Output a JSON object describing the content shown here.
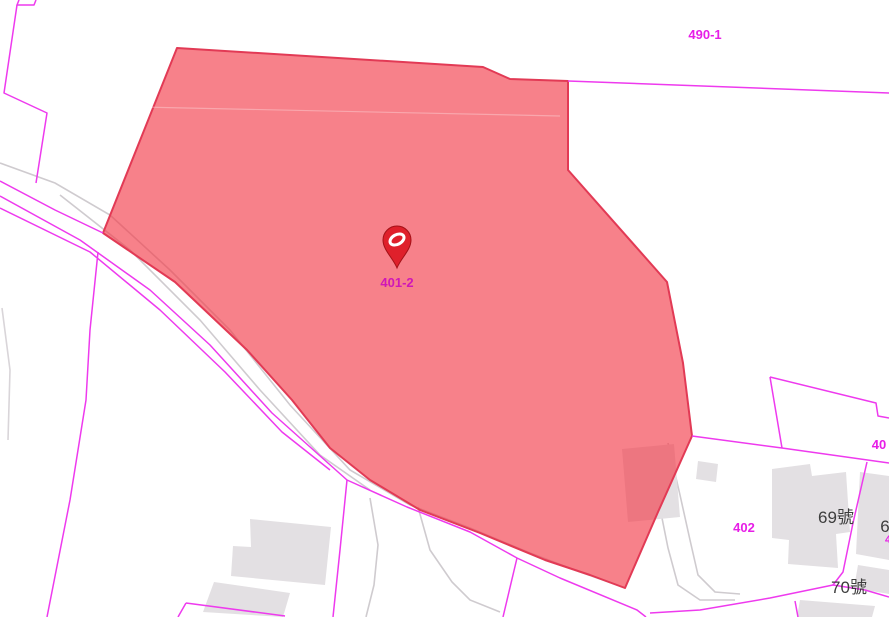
{
  "map": {
    "width": 889,
    "height": 617,
    "colors": {
      "background": "#ffffff",
      "parcel_line": "#ee3aee",
      "road_gray": "#cfcbcf",
      "road_gray_faint": "#d9d5d9",
      "building_fill": "#e3e0e3",
      "highlight_fill": "rgba(243,62,76,0.65)",
      "highlight_edge": "#e23a55",
      "highlight_inner_line": "rgba(255,255,255,0.30)",
      "label_magenta": "#e71ee7",
      "label_magenta_dark": "#cf17b8",
      "label_dark": "#3d3d3d",
      "pin_red": "#df202b",
      "pin_dark": "#a31117",
      "pin_glyph": "#ffffff"
    },
    "marker": {
      "x": 397,
      "y": 244,
      "parcel": "401-2"
    },
    "labels": [
      {
        "id": "parcel-label-490-1",
        "text": "490-1",
        "x": 705,
        "y": 39,
        "color": "magenta",
        "size": 13,
        "weight": "bold"
      },
      {
        "id": "parcel-label-401-2",
        "text": "401-2",
        "x": 397,
        "y": 287,
        "color": "magenta-dark",
        "size": 13,
        "weight": "bold"
      },
      {
        "id": "parcel-label-402",
        "text": "402",
        "x": 744,
        "y": 532,
        "color": "magenta",
        "size": 13,
        "weight": "bold"
      },
      {
        "id": "parcel-label-40",
        "text": "40",
        "x": 879,
        "y": 449,
        "color": "magenta",
        "size": 13,
        "weight": "bold"
      },
      {
        "id": "house-label-69",
        "text": "69號",
        "x": 836,
        "y": 523,
        "color": "dark",
        "size": 17,
        "weight": "normal"
      },
      {
        "id": "house-label-70",
        "text": "70號",
        "x": 849,
        "y": 593,
        "color": "dark",
        "size": 17,
        "weight": "normal"
      },
      {
        "id": "house-label-6x",
        "text": "6",
        "x": 885,
        "y": 532,
        "color": "dark",
        "size": 17,
        "weight": "normal"
      },
      {
        "id": "parcel-label-clipped",
        "text": "4",
        "x": 888,
        "y": 543,
        "color": "magenta",
        "size": 11,
        "weight": "bold"
      }
    ],
    "shapes": {
      "highlight_parcel": "177,48 483,67 510,79 568,81 568,170 667,282 683,363 692,436 658,512 625,588 590,575 545,560 480,533 420,510 370,480 330,448 292,400 247,350 175,282 103,233",
      "highlight_inner_line": "140,107 560,116",
      "building_under_highlight": "622,449 674,444 680,517 628,522",
      "gray_roads": [
        "0,163 55,183 110,215 170,270 230,330 290,405 350,470 410,505 470,528 530,553 580,572 617,585",
        "60,195 130,250 200,320 260,390 320,455 370,490",
        "370,498 378,545 374,585 366,617",
        "418,507 430,550 452,582 470,600 500,612",
        "645,448 658,498 668,548 678,585 700,600 735,600",
        "668,443 680,495 690,540 698,575 715,592 740,594",
        "2,308 10,370 8,440"
      ],
      "buildings": [
        "250,519 331,527 325,585 231,576 233,546 251,547",
        "214,582 290,593 283,617 203,612",
        "698,461 718,464 716,482 696,479",
        "772,469 810,464 812,476 846,472 850,532 836,534 838,568 788,564 789,540 772,538",
        "860,472 889,476 889,560 856,554",
        "858,565 889,570 889,594 854,588",
        "800,600 875,606 872,617 797,617"
      ],
      "parcel_lines": [
        "19,0 17,5 34,5 36,0",
        "17,5 4,93 47,113 36,183",
        "0,181 55,210 103,233",
        "0,196 80,240 150,290 210,345 272,413 347,480 407,507 470,532 517,558 560,578 637,610 646,617",
        "0,208 90,252 160,310 225,372 282,432 330,470",
        "98,252 90,330 86,400 70,500 47,617",
        "347,480 340,550 333,617",
        "517,558 503,617",
        "650,613 700,610 770,598 833,585 865,590 889,597",
        "867,462 853,523 843,572 833,585",
        "795,601 798,617",
        "770,377 876,403 878,416 889,418",
        "770,377 782,448",
        "692,436 782,448 889,463",
        "568,81 889,93",
        "186,603 285,616",
        "186,603 178,617"
      ]
    }
  }
}
